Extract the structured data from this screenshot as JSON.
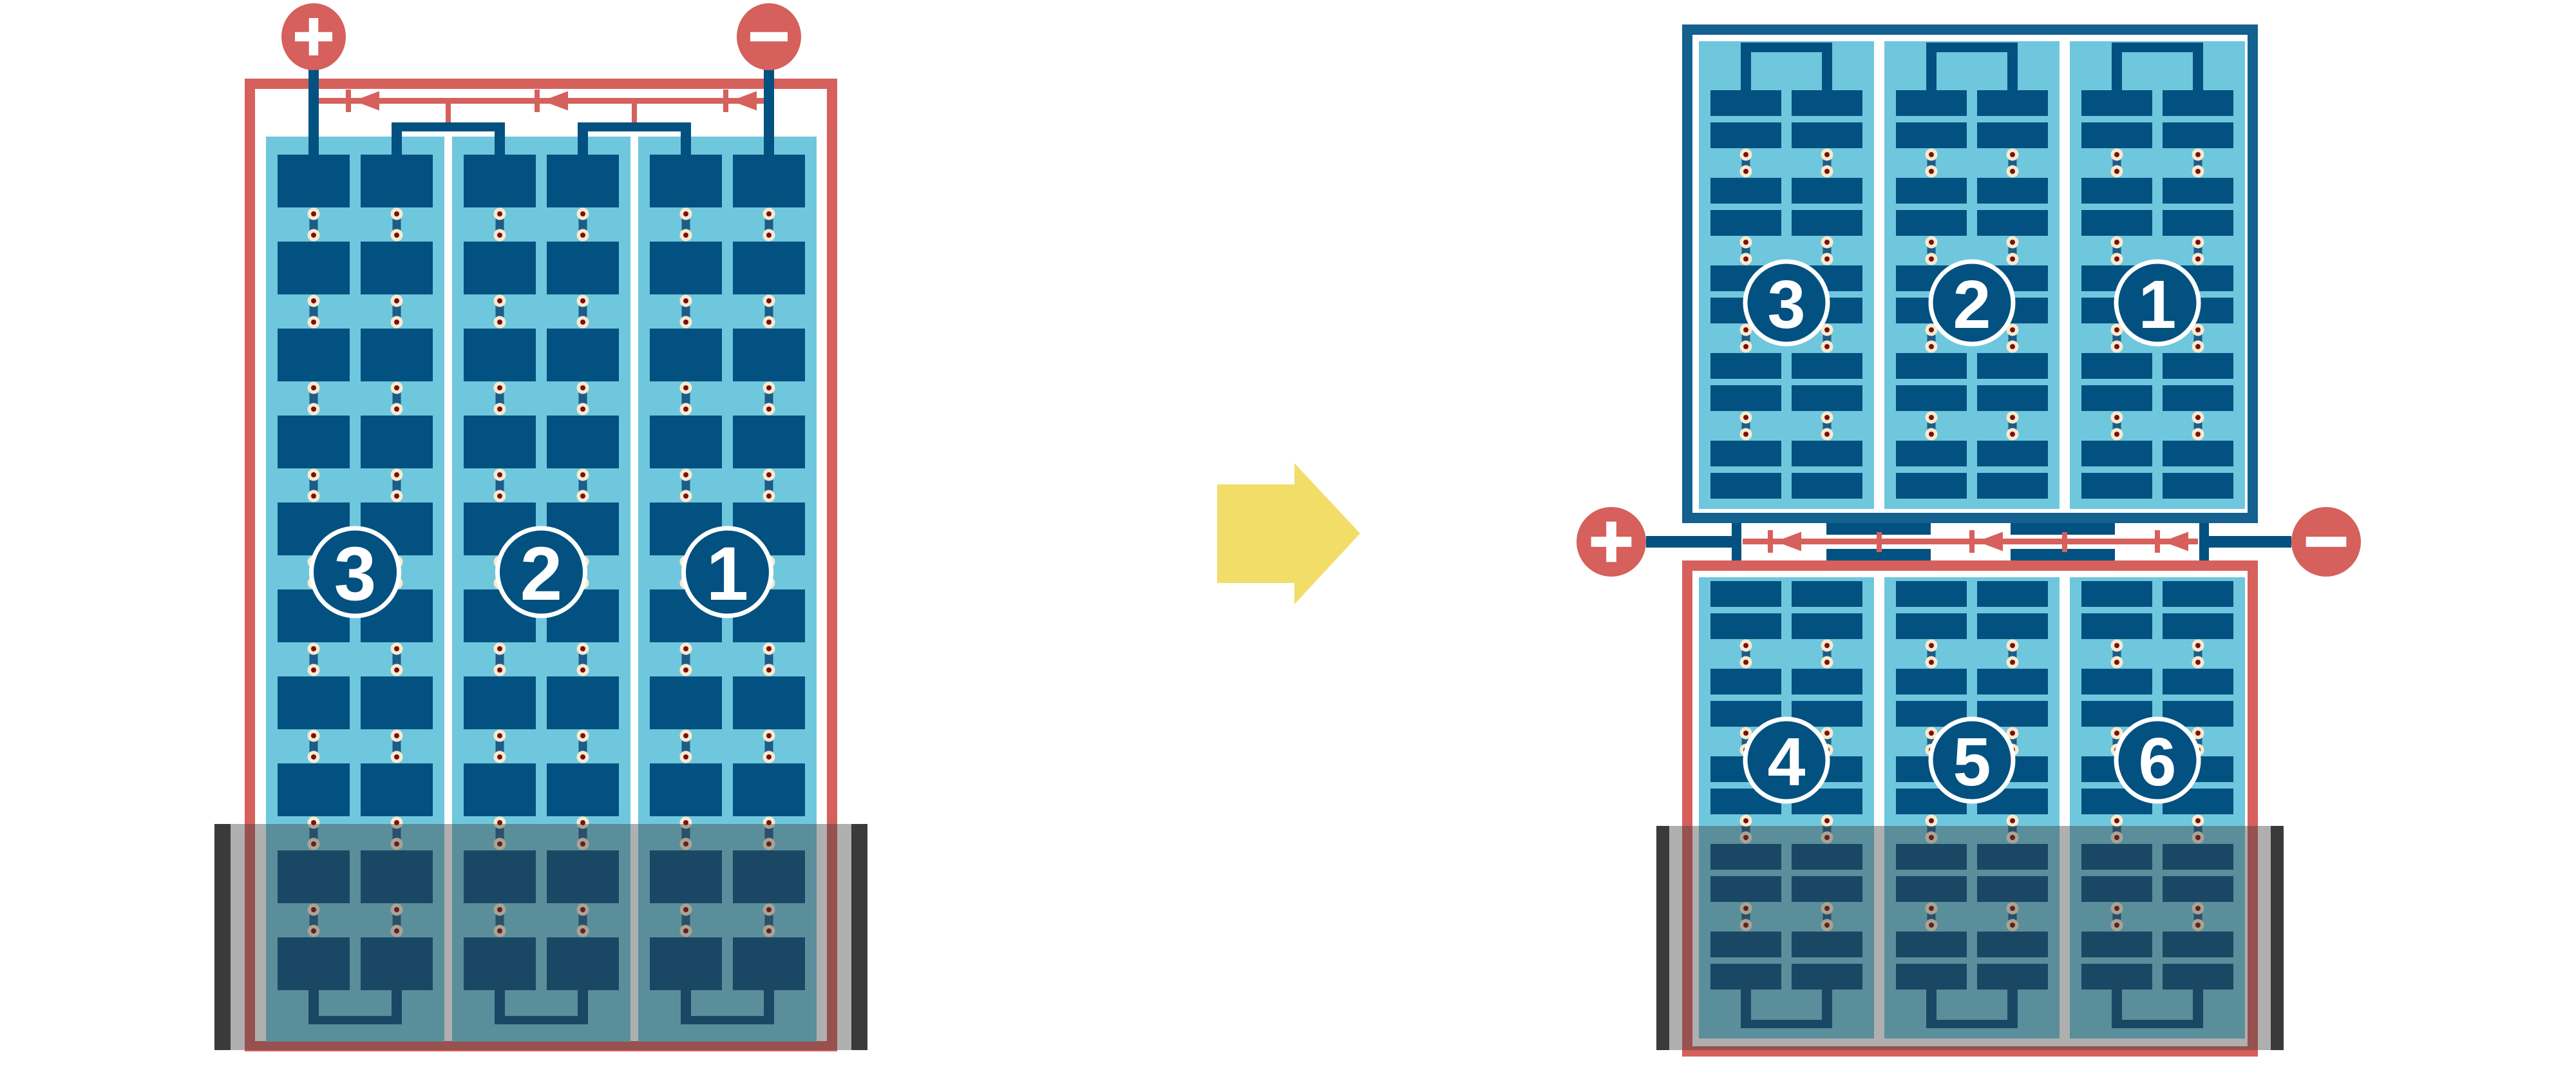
{
  "figure": {
    "type": "diagram",
    "subject": "Solar panel cell strings with bypass diodes: single panel with shaded bottom region, rewired as split top and bottom panels"
  },
  "colors": {
    "red": "#D6605C",
    "navy": "#035180",
    "sky": "#6FC7DD",
    "frame_blue": "#14608F",
    "link": "#1D5C87",
    "cream": "#F6EACF",
    "dot": "#7D100E",
    "yellow": "#F2DD69",
    "rail": "#3A3A3A",
    "shade": "rgba(60,60,60,0.41)",
    "white": "#FFFFFF",
    "background": "#FFFFFF"
  },
  "left_panel": {
    "terminals": [
      {
        "id": "positive",
        "sign": "+"
      },
      {
        "id": "negative",
        "sign": "−"
      }
    ],
    "strings": [
      {
        "number": "3"
      },
      {
        "number": "2"
      },
      {
        "number": "1"
      }
    ]
  },
  "arrow": {
    "direction": "right"
  },
  "right_top_panel": {
    "strings": [
      {
        "number": "3"
      },
      {
        "number": "2"
      },
      {
        "number": "1"
      }
    ]
  },
  "right_bottom_panel": {
    "strings": [
      {
        "number": "4"
      },
      {
        "number": "5"
      },
      {
        "number": "6"
      }
    ]
  },
  "right_terminals": [
    {
      "id": "positive",
      "sign": "+"
    },
    {
      "id": "negative",
      "sign": "−"
    }
  ]
}
